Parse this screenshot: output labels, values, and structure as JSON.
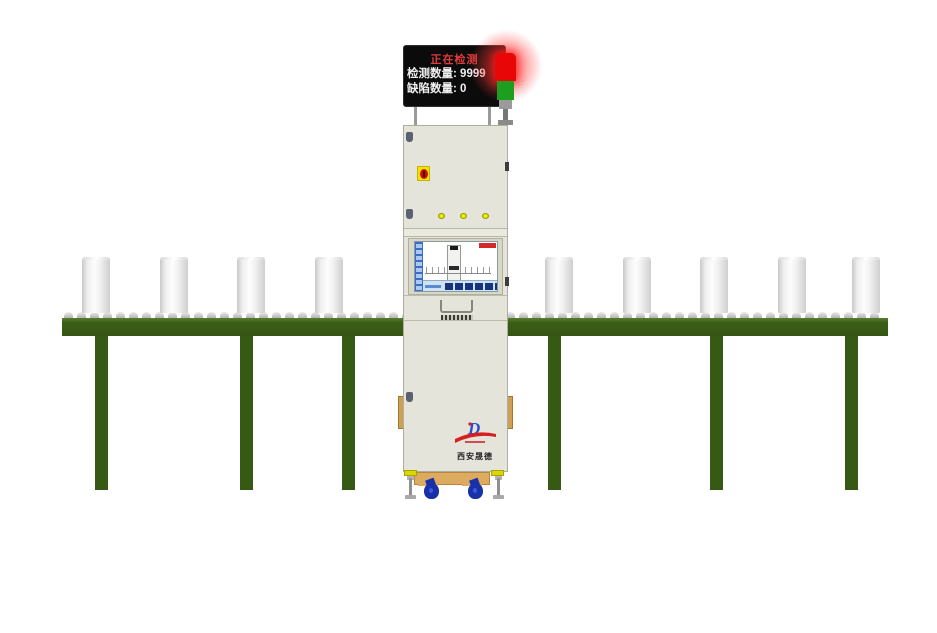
{
  "board": {
    "status": "正在检测",
    "rows": [
      {
        "label": "检测数量:",
        "value": "9999"
      },
      {
        "label": "缺陷数量:",
        "value": "0"
      }
    ]
  },
  "signal_tower": {
    "segments": [
      "red",
      "green"
    ],
    "active_segment": "red"
  },
  "machine": {
    "logo_text": "西安晟德",
    "indicator_count": 3
  },
  "screen": {
    "sidebar_button_count": 8,
    "toolbar_button_count": 6,
    "mini_ticks_left": 4,
    "mini_ticks_right": 5
  },
  "conveyor": {
    "bottle_count": 9,
    "bottle_positions_x": [
      82,
      160,
      237,
      315,
      545,
      623,
      700,
      778,
      852
    ],
    "leg_positions_x": [
      95,
      240,
      342,
      548,
      710,
      845
    ],
    "roller": {
      "start_x": 64,
      "end_x": 876,
      "spacing": 13
    }
  },
  "colors": {
    "conveyor_green": "#365a14",
    "alarm_red": "#e90606",
    "signal_green": "#1e9e1e",
    "board_background": "#0b0b0b",
    "status_text_red": "#e23b3b",
    "cabinet_beige": "#e4e4da",
    "caster_blue": "#1830a8",
    "base_tan": "#dcab60"
  }
}
